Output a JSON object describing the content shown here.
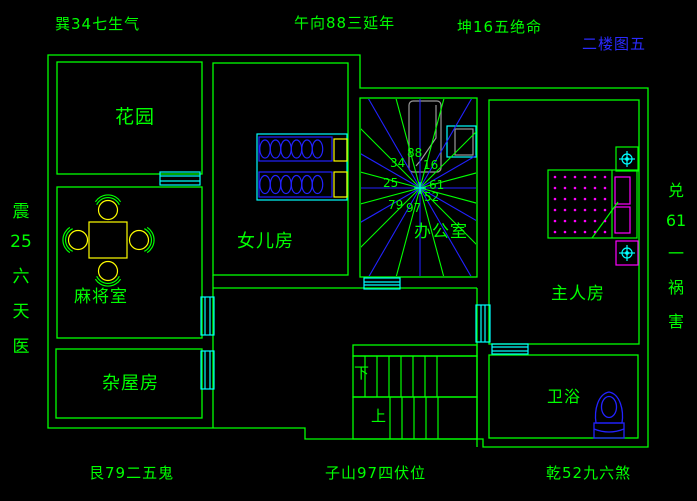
{
  "title": "二楼图五",
  "compass": {
    "top_left": "巽34七生气",
    "top_center": "午向88三延年",
    "top_right": "坤16五绝命",
    "bottom_left": "艮79二五鬼",
    "bottom_center": "子山97四伏位",
    "bottom_right": "乾52九六煞",
    "left_vertical": [
      "震",
      "25",
      "六",
      "天",
      "医"
    ],
    "right_vertical": [
      "兑",
      "61",
      "一",
      "祸",
      "害"
    ]
  },
  "rooms": {
    "garden": "花园",
    "daughter": "女儿房",
    "office": "办公室",
    "mahjong": "麻将室",
    "storage": "杂屋房",
    "master": "主人房",
    "bath": "卫浴"
  },
  "stairs": {
    "down": "下",
    "up": "上"
  },
  "star_numbers": [
    "34",
    "88",
    "16",
    "25",
    "61",
    "79",
    "97",
    "52"
  ],
  "colors": {
    "wall": "#00ff00",
    "window": "#00ffff",
    "furniture_blue": "#2222ff",
    "accent_yellow": "#ffff00",
    "accent_magenta": "#ff00ff",
    "desk_gray": "#9a9a9a",
    "title_blue": "#2a2aff",
    "background": "#000000"
  }
}
